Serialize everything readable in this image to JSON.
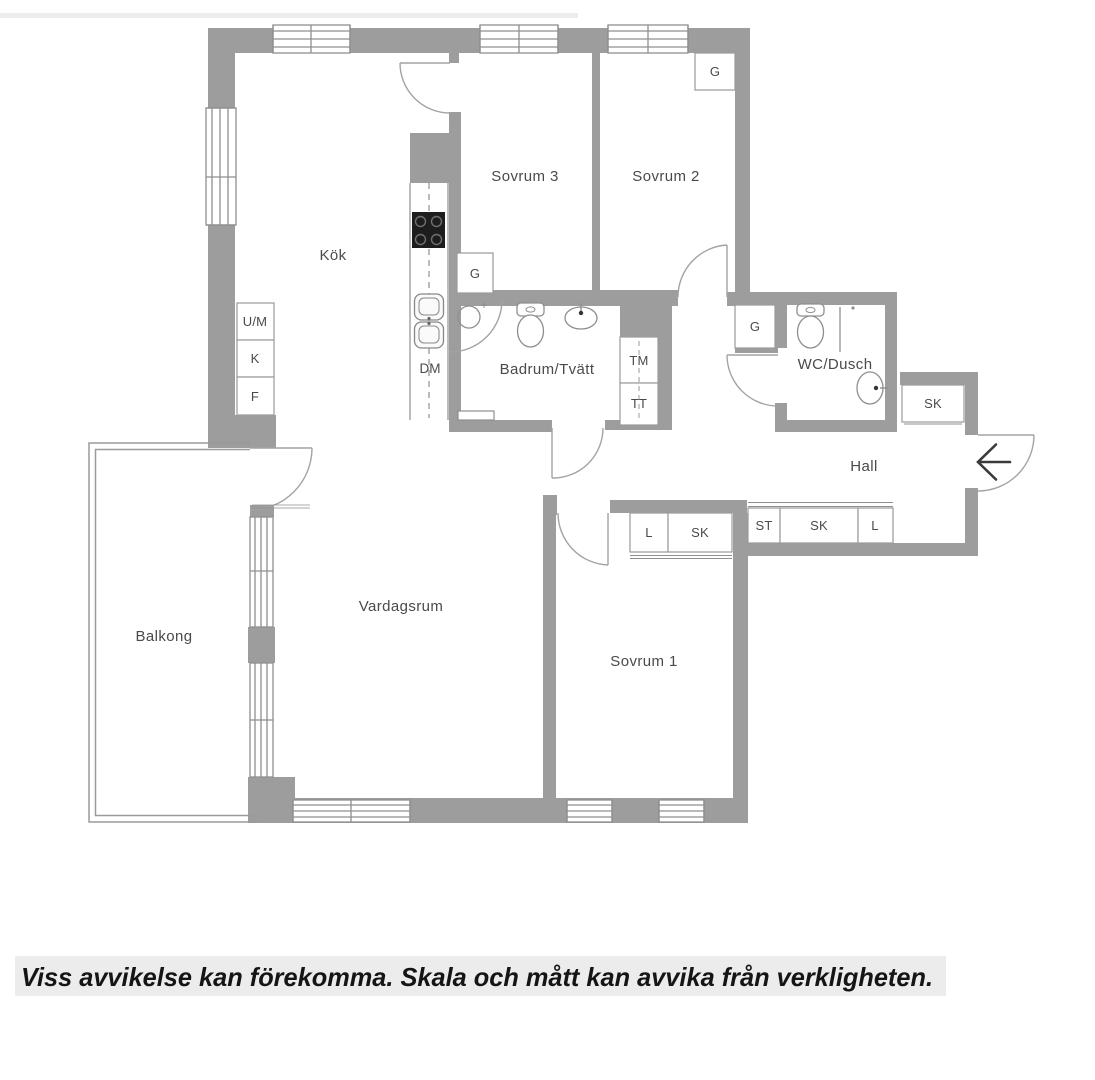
{
  "floorplan": {
    "rooms": {
      "kok": "Kök",
      "sovrum3": "Sovrum 3",
      "sovrum2": "Sovrum 2",
      "badrum": "Badrum/Tvätt",
      "wc": "WC/Dusch",
      "hall": "Hall",
      "vardagsrum": "Vardagsrum",
      "sovrum1": "Sovrum 1",
      "balkong": "Balkong"
    },
    "fixtures": {
      "um": "U/M",
      "k": "K",
      "f": "F",
      "dm": "DM",
      "g": "G",
      "tm": "TM",
      "tt": "TT",
      "sk": "SK",
      "st": "ST",
      "l": "L"
    },
    "colors": {
      "wall": "#9d9d9d",
      "thin_line": "#8f8f8f",
      "label_text": "#4a4a4a",
      "stove": "#1d1d1d",
      "disclaimer_bg": "#ececec"
    }
  },
  "disclaimer": "Viss avvikelse kan förekomma. Skala och mått kan avvika från verkligheten."
}
